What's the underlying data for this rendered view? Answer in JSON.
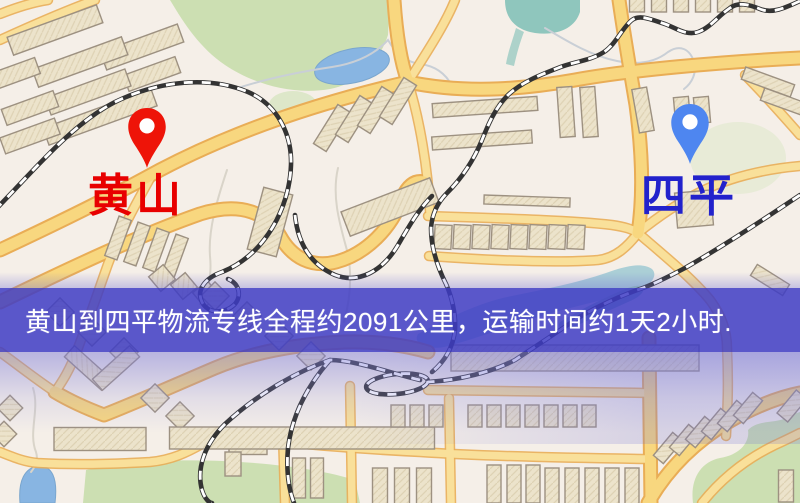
{
  "banner": {
    "text": "黄山到四平物流专线全程约2091公里，运输时间约1天2小时."
  },
  "origin_marker": {
    "label": "黄山"
  },
  "destination_marker": {
    "label": "四平"
  },
  "theme": {
    "banner-bg": "rgba(62,60,196,0.85)",
    "banner-fg": "#ffffff",
    "origin-pin": "#ee1408",
    "origin-label": "#e80000",
    "dest-pin": "#4e86f0",
    "dest-label": "#2222cc",
    "map-bg": "#f5efe8",
    "road-fill": "#f8d77f",
    "road-casing": "#e9ad56",
    "building-fill": "#ece3cb",
    "building-stroke": "#9d9181",
    "park-green": "#ccdfb2",
    "water-blue": "#88b5e2",
    "rail-dark": "#333333"
  }
}
